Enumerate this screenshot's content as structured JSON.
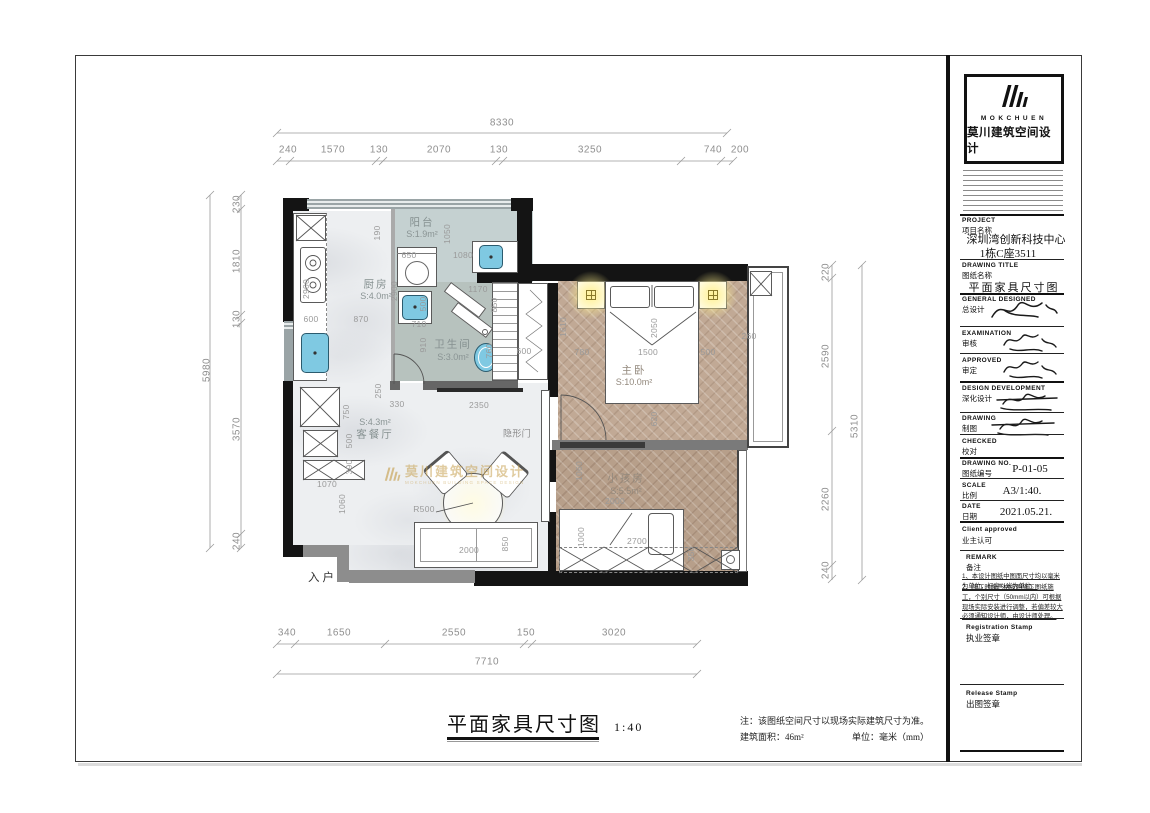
{
  "sheet": {
    "brand": {
      "en": "MOKCHUEN",
      "cn": "莫川建筑空间设计",
      "watermark_sub": "MOKCHUEN BUILDING SPACE DESIGN"
    },
    "title_block": {
      "project": {
        "en": "PROJECT",
        "cn": "项目名称",
        "line1": "深圳湾创新科技中心",
        "line2": "1栋C座3511"
      },
      "drawing_title": {
        "en": "DRAWING TITLE",
        "cn": "图纸名称",
        "value": "平面家具尺寸图"
      },
      "general_designed": {
        "en": "GENERAL  DESIGNED",
        "cn": "总设计"
      },
      "examination": {
        "en": "EXAMINATION",
        "cn": "审核"
      },
      "approved": {
        "en": "APPROVED",
        "cn": "审定"
      },
      "design_development": {
        "en": "DESIGN DEVELOPMENT",
        "cn": "深化设计"
      },
      "drawing": {
        "en": "DRAWING",
        "cn": "制图"
      },
      "checked": {
        "en": "CHECKED",
        "cn": "校对"
      },
      "drawing_no": {
        "en": "DRAWING NO.",
        "cn": "图纸编号",
        "value": "P-01-05"
      },
      "scale": {
        "en": "SCALE",
        "cn": "比例",
        "value": "A3/1:40."
      },
      "date": {
        "en": "DATE",
        "cn": "日期",
        "value": "2021.05.21."
      },
      "client_approved": {
        "en": "Client approved",
        "cn": "业主认可"
      },
      "remark": {
        "en": "REMARK",
        "cn": "备注",
        "note1": "1、本设计图纸中图面尺寸均以毫米为单位，标高以米为单位。",
        "note2": "2、施工时须严格按照施工图纸施工，个别尺寸（50mm以内）可根据现场实际安装进行调整，若偏差较大必须通知设计师，由设计师处理。"
      },
      "registration_stamp": {
        "en": "Registration Stamp",
        "cn": "执业签章"
      },
      "release_stamp": {
        "en": "Release Stamp",
        "cn": "出图签章"
      }
    },
    "footer": {
      "title": "平面家具尺寸图",
      "scale": "1:40",
      "note": "注：该图纸空间尺寸以现场实际建筑尺寸为准。",
      "area": "建筑面积：46m²",
      "unit": "单位：毫米（mm）"
    }
  },
  "plan": {
    "rooms": [
      {
        "name": "阳台",
        "area": "S:1.9m²"
      },
      {
        "name": "厨房",
        "area": "S:4.0m²"
      },
      {
        "name": "卫生间",
        "area": "S:3.0m²"
      },
      {
        "name": "主卧",
        "area": "S:10.0m²"
      },
      {
        "name": "小孩房",
        "area": "S:5.5m²"
      },
      {
        "name": "客餐厅",
        "area": "S:4.3m²"
      }
    ],
    "labels": {
      "entrance": "入户",
      "hidden_door": "隐形门"
    },
    "dims": {
      "top": {
        "total": "8330",
        "segments": [
          "240",
          "1570",
          "130",
          "2070",
          "130",
          "3250",
          "740",
          "200"
        ]
      },
      "left": {
        "total": "5980",
        "segments": [
          "230",
          "1810",
          "130",
          "3570",
          "240"
        ]
      },
      "right": {
        "total": "5310",
        "segments": [
          "220",
          "2590",
          "2260",
          "240"
        ]
      },
      "bottom": {
        "total": "7710",
        "segments": [
          "340",
          "1650",
          "2550",
          "150",
          "3020"
        ]
      },
      "interior": [
        "650",
        "1050",
        "1080",
        "190",
        "2900",
        "2900",
        "600",
        "870",
        "500",
        "710",
        "1170",
        "850",
        "910",
        "760",
        "600",
        "1610",
        "780",
        "1500",
        "500",
        "2050",
        "620",
        "260",
        "250",
        "330",
        "2350",
        "750",
        "500",
        "390",
        "1070",
        "1060",
        "1060",
        "2000",
        "1000",
        "2700",
        "350",
        "2000",
        "850",
        "R500"
      ]
    }
  }
}
